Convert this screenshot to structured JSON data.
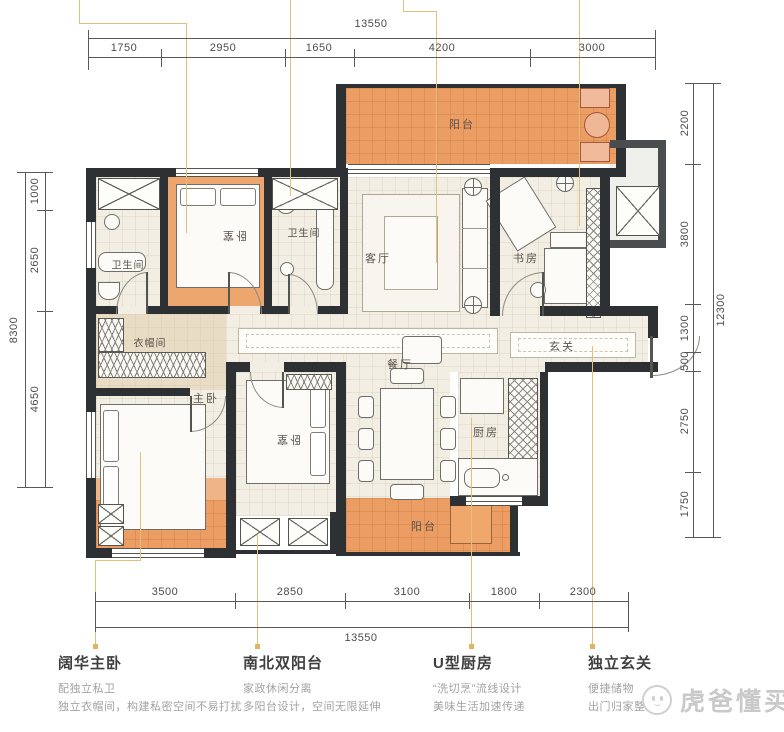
{
  "watermark": {
    "brand": "虎爸懂买房"
  },
  "dimensions": {
    "top": {
      "total": "13550",
      "segments": [
        "1750",
        "2950",
        "1650",
        "4200",
        "3000"
      ]
    },
    "bottom": {
      "total": "13550",
      "segments": [
        "3500",
        "2850",
        "3100",
        "1800",
        "2300"
      ]
    },
    "left": {
      "total": "8300",
      "segments": [
        "1000",
        "2650",
        "4650"
      ]
    },
    "right": {
      "total": "12300",
      "segments": [
        "2200",
        "3800",
        "1300",
        "500",
        "2750",
        "1750"
      ]
    }
  },
  "rooms": {
    "balcony_top": "阳台",
    "bath_left": "卫生间",
    "bedroom_top": "卧室",
    "bath_mid": "卫生间",
    "living": "客厅",
    "study": "书房",
    "cloakroom": "衣帽间",
    "master": "主卧",
    "bedroom_bottom": "卧室",
    "dining": "餐厅",
    "kitchen": "厨房",
    "foyer": "玄关",
    "balcony_bottom": "阳台"
  },
  "annotations": {
    "master": {
      "title": "阔华主卧",
      "line1": "配独立私卫",
      "line2": "独立衣帽间，构建私密空间不易打扰"
    },
    "balcony": {
      "title": "南北双阳台",
      "line1": "家政休闲分离",
      "line2": "多阳台设计，空间无限延伸"
    },
    "kitchen": {
      "title": "U型厨房",
      "line1": "“洗切烹”流线设计",
      "line2": "美味生活加速传递"
    },
    "foyer": {
      "title": "独立玄关",
      "line1": "便捷储物",
      "line2": "出门归家整洁"
    }
  }
}
